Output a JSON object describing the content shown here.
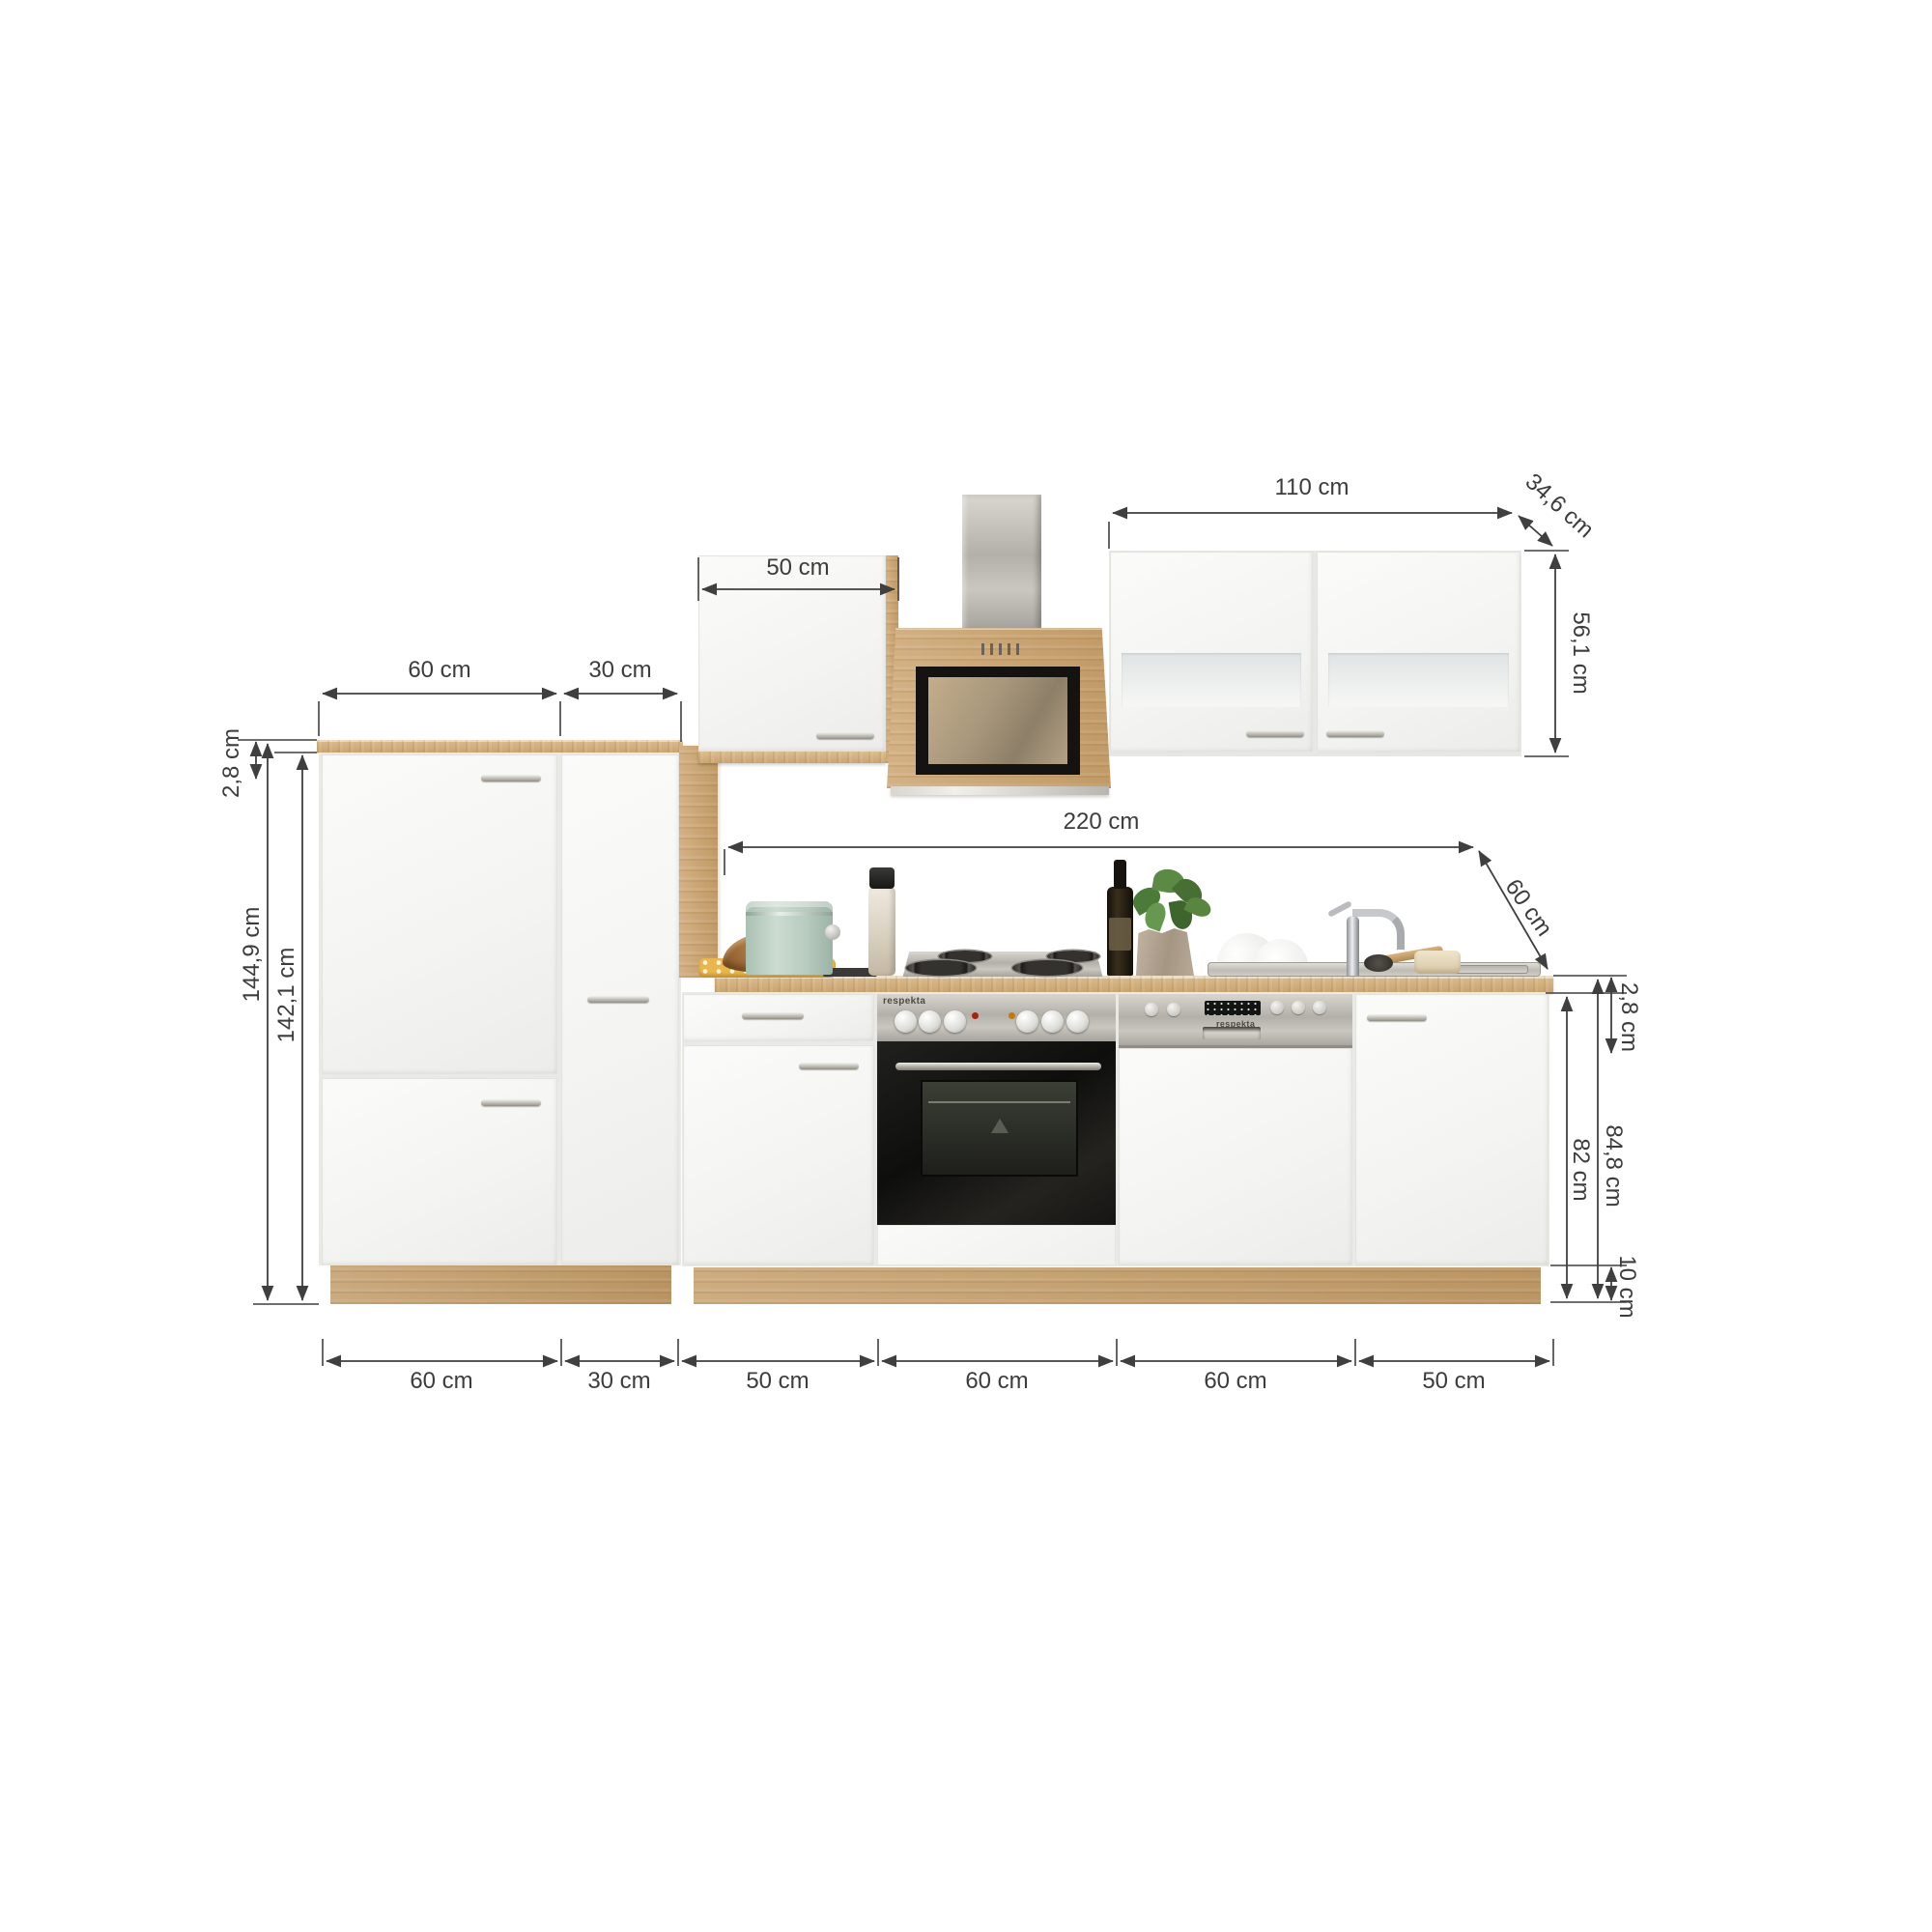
{
  "dims": {
    "wall_left_width": "50 cm",
    "wall_right_width": "110 cm",
    "wall_depth": "34,6 cm",
    "wall_height": "56,1 cm",
    "tall_seg1": "60 cm",
    "tall_seg2": "30 cm",
    "tall_worktop_thickness": "2,8 cm",
    "tall_total_height": "144,9 cm",
    "tall_body_height": "142,1 cm",
    "run_length": "220 cm",
    "worktop_depth": "60 cm",
    "worktop_thickness": "2,8 cm",
    "base_total_height": "84,8 cm",
    "base_body_height": "82 cm",
    "plinth_height": "10 cm",
    "bottom_widths": [
      "60 cm",
      "30 cm",
      "50 cm",
      "60 cm",
      "60 cm",
      "50 cm"
    ]
  },
  "branding": {
    "oven": "respekta",
    "dishwasher": "respekta"
  },
  "colors": {
    "dimension_lines": "#3f3f3f",
    "oak_wood": "#cda771",
    "worktop": "#d6b488",
    "front_white": "#f5f5f3",
    "stainless_steel": "#b5b3ab",
    "mint_canister": "#c0d3c7",
    "cloth_yellow": "#e8b64c",
    "basil_green": "#56823f"
  }
}
